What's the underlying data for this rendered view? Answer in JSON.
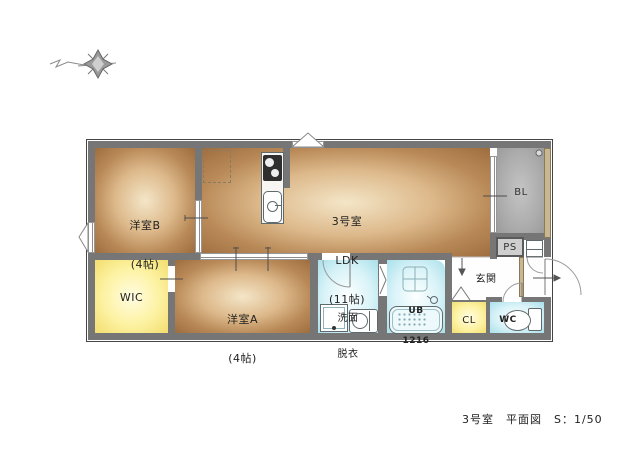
{
  "plan_title": {
    "caption": "3号室　平面図　S：1/50"
  },
  "rooms": {
    "yoshitsu_b": {
      "name": "洋室B",
      "size": "(4帖)"
    },
    "ldk": {
      "unit": "3号室",
      "name": "LDK",
      "size": "(11帖)"
    },
    "balcony": {
      "name": "BL"
    },
    "pipe_space": {
      "name": "PS"
    },
    "wic": {
      "name": "WIC"
    },
    "yoshitsu_a": {
      "name": "洋室A",
      "size": "(4帖)"
    },
    "senmen": {
      "line1": "洗面",
      "line2": "脱衣"
    },
    "unit_bath": {
      "name": "UB",
      "size": "1216"
    },
    "genkan": {
      "name": "玄関"
    },
    "closet": {
      "name": "CL"
    },
    "wc": {
      "name": "WC"
    }
  },
  "fixtures": {
    "compass": "compass-sketch",
    "refrigerator": "refrigerator-space-dashed",
    "stove": "two-burner-stove",
    "kitchen_sink": "kitchen-sink",
    "washing_machine": "washing-machine-pan",
    "vanity": "wash-basin",
    "bathtub": "bathtub",
    "shower_stool": "bath-counter",
    "toilet": "toilet",
    "shoe_cabinet": "shoe-cabinet",
    "drain": "balcony-drain"
  },
  "colors": {
    "wall": "#767676",
    "wood_edge": "#9e6d3f",
    "wood_center": "#f4e6c8",
    "closet_yellow": "#f2dd6e",
    "wet_cyan": "#a9e0ea",
    "balcony_gray": "#9b9b9b",
    "exterior_tan": "#c9b794"
  }
}
